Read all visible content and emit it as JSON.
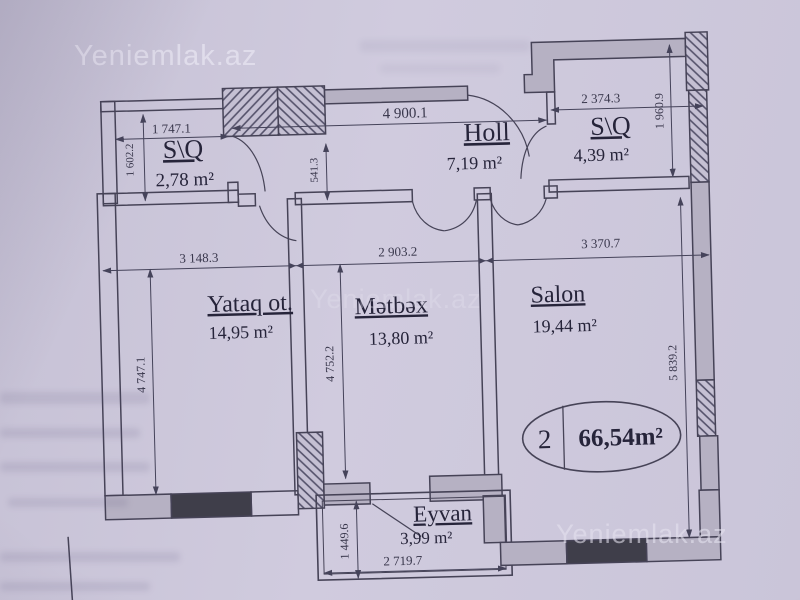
{
  "watermark": "Yeniemlak.az",
  "plan": {
    "rooms": {
      "sq_left": {
        "name": "S\\Q",
        "area": "2,78 m²"
      },
      "holl": {
        "name": "Holl",
        "area": "7,19 m²"
      },
      "sq_right": {
        "name": "S\\Q",
        "area": "4,39 m²"
      },
      "yataq": {
        "name": "Yataq ot.",
        "area": "14,95 m²"
      },
      "metbex": {
        "name": "Mətbəx",
        "area": "13,80 m²"
      },
      "salon": {
        "name": "Salon",
        "area": "19,44 m²"
      },
      "eyvan": {
        "name": "Eyvan",
        "area": "3,99 m²"
      }
    },
    "dims": {
      "sq_left_w": "1 747.1",
      "sq_left_h": "1 602.2",
      "holl_w": "4 900.1",
      "holl_wall": "541.3",
      "sq_right_w": "2 374.3",
      "sq_right_h": "1 960.9",
      "yataq_w": "3 148.3",
      "yataq_h": "4 747.1",
      "metbex_w": "2 903.2",
      "metbex_h": "4 752.2",
      "salon_w": "3 370.7",
      "salon_h": "5 839.2",
      "eyvan_w": "2 719.7",
      "eyvan_h": "1 449.6"
    },
    "badge": {
      "room_count": "2",
      "total_area": "66,54m²"
    }
  },
  "colors": {
    "paper": "#cdc8da",
    "ink": "#464357",
    "wall_fill": "#b6b1c3",
    "wall_dark": "#3f3e4a"
  }
}
